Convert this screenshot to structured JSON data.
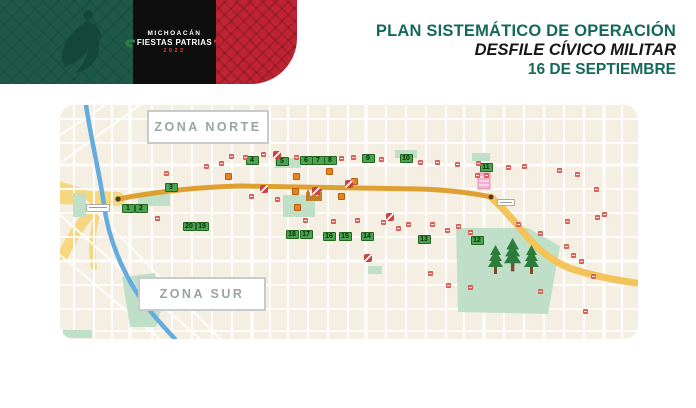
{
  "header": {
    "brand": {
      "region": "MICHOACÁN",
      "event": "FIESTAS PATRIAS",
      "year": "2023"
    },
    "title": {
      "line1": "PLAN SISTEMÁTICO DE OPERACIÓN",
      "line2": "DESFILE CÍVICO MILITAR",
      "line3": "16 DE SEPTIEMBRE"
    },
    "colors": {
      "panel_green": "#1E5848",
      "panel_black": "#0E0E0E",
      "panel_red": "#C02433",
      "title_green": "#15695A"
    }
  },
  "map": {
    "zone_north": "ZONA NORTE",
    "zone_south": "ZONA SUR",
    "colors": {
      "background": "#F5EFE3",
      "street": "#FFFFFF",
      "river": "#66ABDD",
      "route_main": "#DFA032",
      "route_tail": "#F2C45A",
      "park": "#BFDFC9",
      "marker_green": "#4BA450",
      "marker_red": "#D7605A",
      "marker_orange": "#E8831F"
    },
    "route_markers": [
      {
        "n": 1,
        "x": 68,
        "y": 103
      },
      {
        "n": 2,
        "x": 81,
        "y": 103
      },
      {
        "n": 3,
        "x": 111,
        "y": 82
      },
      {
        "n": 4,
        "x": 192,
        "y": 55
      },
      {
        "n": 5,
        "x": 222,
        "y": 56
      },
      {
        "n": 6,
        "x": 246,
        "y": 55
      },
      {
        "n": 7,
        "x": 258,
        "y": 55
      },
      {
        "n": 8,
        "x": 270,
        "y": 55
      },
      {
        "n": 9,
        "x": 308,
        "y": 53
      },
      {
        "n": 10,
        "x": 346,
        "y": 53
      },
      {
        "n": 11,
        "x": 426,
        "y": 62
      },
      {
        "n": 12,
        "x": 417,
        "y": 135
      },
      {
        "n": 13,
        "x": 364,
        "y": 134
      },
      {
        "n": 14,
        "x": 307,
        "y": 131
      },
      {
        "n": 15,
        "x": 285,
        "y": 131
      },
      {
        "n": 16,
        "x": 269,
        "y": 131
      },
      {
        "n": 17,
        "x": 246,
        "y": 129
      },
      {
        "n": 18,
        "x": 232,
        "y": 129
      },
      {
        "n": 19,
        "x": 142,
        "y": 121
      },
      {
        "n": 20,
        "x": 129,
        "y": 121
      }
    ],
    "red_markers": [
      [
        171,
        51
      ],
      [
        185,
        52
      ],
      [
        203,
        49
      ],
      [
        236,
        52
      ],
      [
        281,
        53
      ],
      [
        293,
        52
      ],
      [
        321,
        54
      ],
      [
        360,
        57
      ],
      [
        377,
        57
      ],
      [
        397,
        59
      ],
      [
        418,
        58
      ],
      [
        448,
        62
      ],
      [
        464,
        61
      ],
      [
        499,
        65
      ],
      [
        517,
        69
      ],
      [
        536,
        84
      ],
      [
        544,
        109
      ],
      [
        537,
        112
      ],
      [
        507,
        116
      ],
      [
        480,
        128
      ],
      [
        458,
        119
      ],
      [
        106,
        68
      ],
      [
        146,
        61
      ],
      [
        161,
        58
      ],
      [
        191,
        91
      ],
      [
        217,
        94
      ],
      [
        245,
        115
      ],
      [
        273,
        116
      ],
      [
        297,
        115
      ],
      [
        323,
        117
      ],
      [
        338,
        123
      ],
      [
        348,
        119
      ],
      [
        372,
        119
      ],
      [
        387,
        125
      ],
      [
        398,
        121
      ],
      [
        410,
        127
      ],
      [
        97,
        113
      ],
      [
        370,
        168
      ],
      [
        388,
        180
      ],
      [
        410,
        182
      ],
      [
        480,
        186
      ],
      [
        506,
        141
      ],
      [
        513,
        150
      ],
      [
        521,
        156
      ],
      [
        525,
        206
      ],
      [
        533,
        171
      ],
      [
        417,
        70
      ],
      [
        426,
        70
      ]
    ],
    "orange_markers": [
      [
        168,
        71
      ],
      [
        236,
        71
      ],
      [
        269,
        66
      ],
      [
        294,
        76
      ],
      [
        235,
        86
      ],
      [
        237,
        102
      ],
      [
        281,
        91
      ]
    ],
    "no_entry_markers": [
      [
        217,
        50
      ],
      [
        204,
        84
      ],
      [
        256,
        86
      ],
      [
        289,
        79
      ],
      [
        330,
        112
      ],
      [
        308,
        153
      ]
    ]
  }
}
